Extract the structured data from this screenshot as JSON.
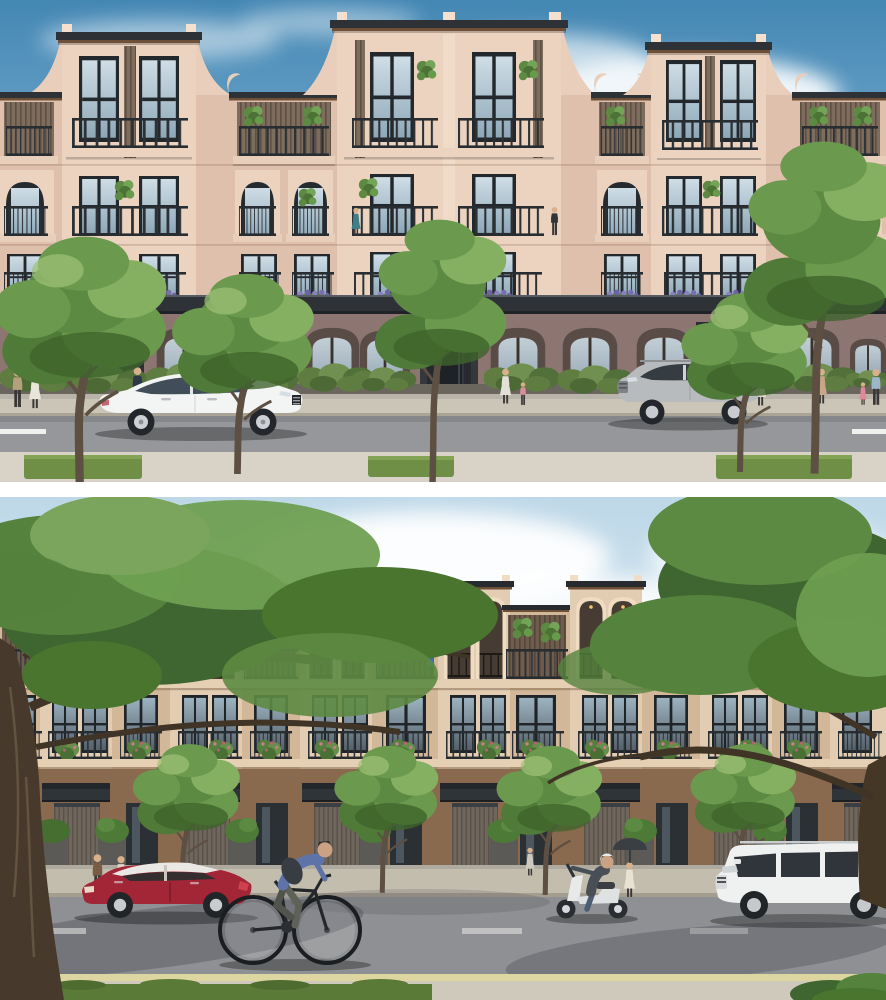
{
  "page": {
    "width": 886,
    "height": 1000,
    "background": "#ffffff",
    "layout": "two stacked architectural renderings separated by a white gap"
  },
  "scene": {
    "type": "architectural exterior rendering",
    "subject": "row of four-storey shophouse townhouses along a tree-lined street",
    "views": [
      "eye-level street elevation, daytime sky",
      "closer street elevation framed by large foreground trees"
    ]
  },
  "panel_top": {
    "sky": {
      "top": "#4487b4",
      "mid": "#7fb2d2",
      "horizon": "#c9e0ee",
      "clouds": "#ffffff"
    },
    "building": {
      "stucco_light": "#ecd3bf",
      "stucco_mid": "#dfc0ac",
      "stucco_shadow": "#e9cfbb",
      "pilaster": "#f4e0cd",
      "roof_cap": "#2e3237",
      "wood_beam": "#6e4f38",
      "slat_wall": "#7e6c5d",
      "window_frame": "#23282d",
      "glass_light": "#cfdde6",
      "glass_deep": "#8ea8b8",
      "colonnade_wall": "#8d7672",
      "arch_interior": "#594b46",
      "entry_portal": "#34373c"
    },
    "street": {
      "sidewalk_far": "#cbc5b7",
      "curb": "#a9a496",
      "road": "#96979a",
      "lane_marking": "#f0f0ec",
      "sidewalk_near": "#d8d3c6",
      "grass": "#6f8f46"
    },
    "vegetation": {
      "foliage_dark": "#4f7a38",
      "foliage_mid": "#6b9a4e",
      "foliage_light": "#86b061",
      "trunk": "#5d4f41",
      "hedge": "#5f7d40"
    },
    "vehicles": [
      {
        "label": "white luxury sedan, facing right",
        "color": "#f3f5f5"
      },
      {
        "label": "silver compact SUV, facing left",
        "color": "#b8bbbd"
      }
    ],
    "people": [
      "couple strolling far left",
      "man in dark suit at shopfront",
      "woman and child at central entrance",
      "woman walking mid-right",
      "woman with umbrella",
      "woman with children far right",
      "figures on upper balconies"
    ]
  },
  "panel_bottom": {
    "sky": {
      "top": "#bed8e8",
      "horizon": "#ecf4f9",
      "clouds": "#ffffff"
    },
    "building": {
      "stucco_light": "#e3cdb2",
      "stucco_mid": "#d3b799",
      "arch_interior": "#473c33",
      "ground_floor": "#8a6a4e",
      "garage_door": "#6f665c",
      "canopy": "#2f3438",
      "slat_wall": "#6e5c4c",
      "planter_stone": "#5b5a56",
      "arch_downlight": "#f6c572"
    },
    "street": {
      "sidewalk_far": "#c3bdae",
      "road": "#8f9093",
      "lane_marking": "#e8e8e4",
      "edge_line_yellow": "#ddd6a0",
      "sidewalk_near": "#cfc9bc",
      "grass": "#5a7a38"
    },
    "vegetation": {
      "foliage_dark": "#3f6631",
      "foliage_mid": "#55833d",
      "foliage_light": "#6fa052",
      "trunk_large": "#473a2c"
    },
    "vehicles": [
      {
        "label": "red hatchback with white roof, facing left",
        "color": "#a32637"
      },
      {
        "label": "white motor scooter with rider",
        "color": "#e8eaea"
      },
      {
        "label": "white boxy SUV, facing left",
        "color": "#eff1f1"
      },
      {
        "label": "black bicycle with male rider, heading right",
        "color": "#23262a"
      }
    ],
    "people": [
      "two residents by left hedge",
      "cyclist in plaid shirt",
      "scooter rider with white helmet",
      "woman with umbrella",
      "figure at entrance door",
      "man walking far right",
      "figures on balconies"
    ]
  }
}
